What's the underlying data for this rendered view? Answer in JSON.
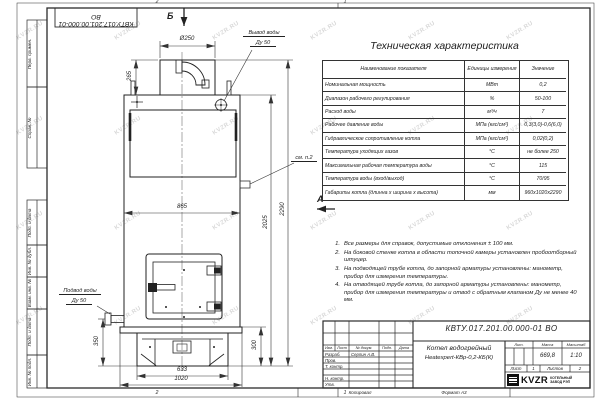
{
  "watermark": {
    "text": "KVZR.RU"
  },
  "frame": {
    "corner_ref": "КВТУ.017.201.00.000-01 ВО",
    "side_labels": {
      "perv": "Перв. примен.",
      "sprav": "Справ. №",
      "podp1": "Подп. и дата",
      "inv_dubl": "Инв. № дубл.",
      "vzam": "Взам. инв. №",
      "podp2": "Подп. и дата",
      "inv_podl": "Инв. № подл."
    },
    "zones": {
      "top_left": "2",
      "top_right": "1",
      "bottom_left": "2",
      "bottom_right": "1"
    }
  },
  "drawing": {
    "views": {
      "b": "Б",
      "a": "А"
    },
    "labels": {
      "outlet_line1": "Вывод воды",
      "outlet_line2": "Ду 50",
      "inlet_line1": "Подвод воды",
      "inlet_line2": "Ду 50",
      "see_note": "см. п.2"
    },
    "dims": {
      "flue": "Ø250",
      "collar": "265",
      "width": "865",
      "h_total": "2290",
      "h_body": "2025",
      "inlet_h": "350",
      "base_h": "300",
      "base_w": "633",
      "overall_w": "1020"
    }
  },
  "spec_table": {
    "title": "Техническая характеристика",
    "headers": [
      "Наименование показателя",
      "Единицы измерения",
      "Значение"
    ],
    "rows": [
      {
        "name": "Номинальная мощность",
        "unit": "МВт",
        "value": "0,2"
      },
      {
        "name": "Диапазон рабочего регулирования",
        "unit": "%",
        "value": "50-100"
      },
      {
        "name": "Расход воды",
        "unit": "м³/ч",
        "value": "7"
      },
      {
        "name": "Рабочее давление воды",
        "unit": "МПа (кгс/см²)",
        "value": "0,3(3,0)-0,6(6,0)"
      },
      {
        "name": "Гидравлическое сопротивление котла",
        "unit": "МПа (кгс/см²)",
        "value": "0,02(0,2)"
      },
      {
        "name": "Температура уходящих газов",
        "unit": "°С",
        "value": "не более 250"
      },
      {
        "name": "Максимальная рабочая температура воды",
        "unit": "°С",
        "value": "115"
      },
      {
        "name": "Температура воды (вход/выход)",
        "unit": "°С",
        "value": "70/95"
      },
      {
        "name": "Габариты котла (длинна х ширина х высота)",
        "unit": "мм",
        "value": "960х1020х2290"
      }
    ]
  },
  "notes": {
    "items": [
      {
        "num": "1.",
        "text": "Все размеры для справок, допустимые отклонения ± 100 мм."
      },
      {
        "num": "2.",
        "text": "На боковой стенке котла в области топочной камеры установлен пробоотборный штуцер."
      },
      {
        "num": "3.",
        "text": "На подводящей трубе котла, до запорной арматуры установлены: манометр, прибор для измерения температуры."
      },
      {
        "num": "4.",
        "text": "На отводящей трубе котла, до запорной арматуры установлены: манометр, прибор для измерения температуры и отвод с обратным клапаном Ду не менее 40 мм."
      }
    ]
  },
  "title_block": {
    "designation": "КВТУ.017.201.00.000-01 ВО",
    "product_line1": "Котел водогрейный",
    "product_line2": "Heatexpert-КВр-0,2-КБ(К)",
    "lit_label": "Лит.",
    "mass_label": "Масса",
    "scale_label": "Масштаб",
    "mass": "669,8",
    "scale": "1:10",
    "sheet_label": "Лист",
    "sheet": "1",
    "sheets_label": "Листов",
    "sheets": "2",
    "cols": {
      "izm": "Изм.",
      "list": "Лист",
      "doc": "№ докум.",
      "podp": "Подп.",
      "data": "Дата"
    },
    "rows": {
      "razrab": "Разраб.",
      "razrab_name": "Серпин А.В.",
      "prov": "Пров.",
      "tkontr": "Т. контр.",
      "nkontr": "Н. контр.",
      "utv": "Утв."
    },
    "logo": {
      "text": "KVZR",
      "sub1": "КОТЕЛЬНЫЙ",
      "sub2": "ЗАВОД РЭП"
    },
    "footer": {
      "copied": "Копировал",
      "format": "Формат А3"
    }
  }
}
